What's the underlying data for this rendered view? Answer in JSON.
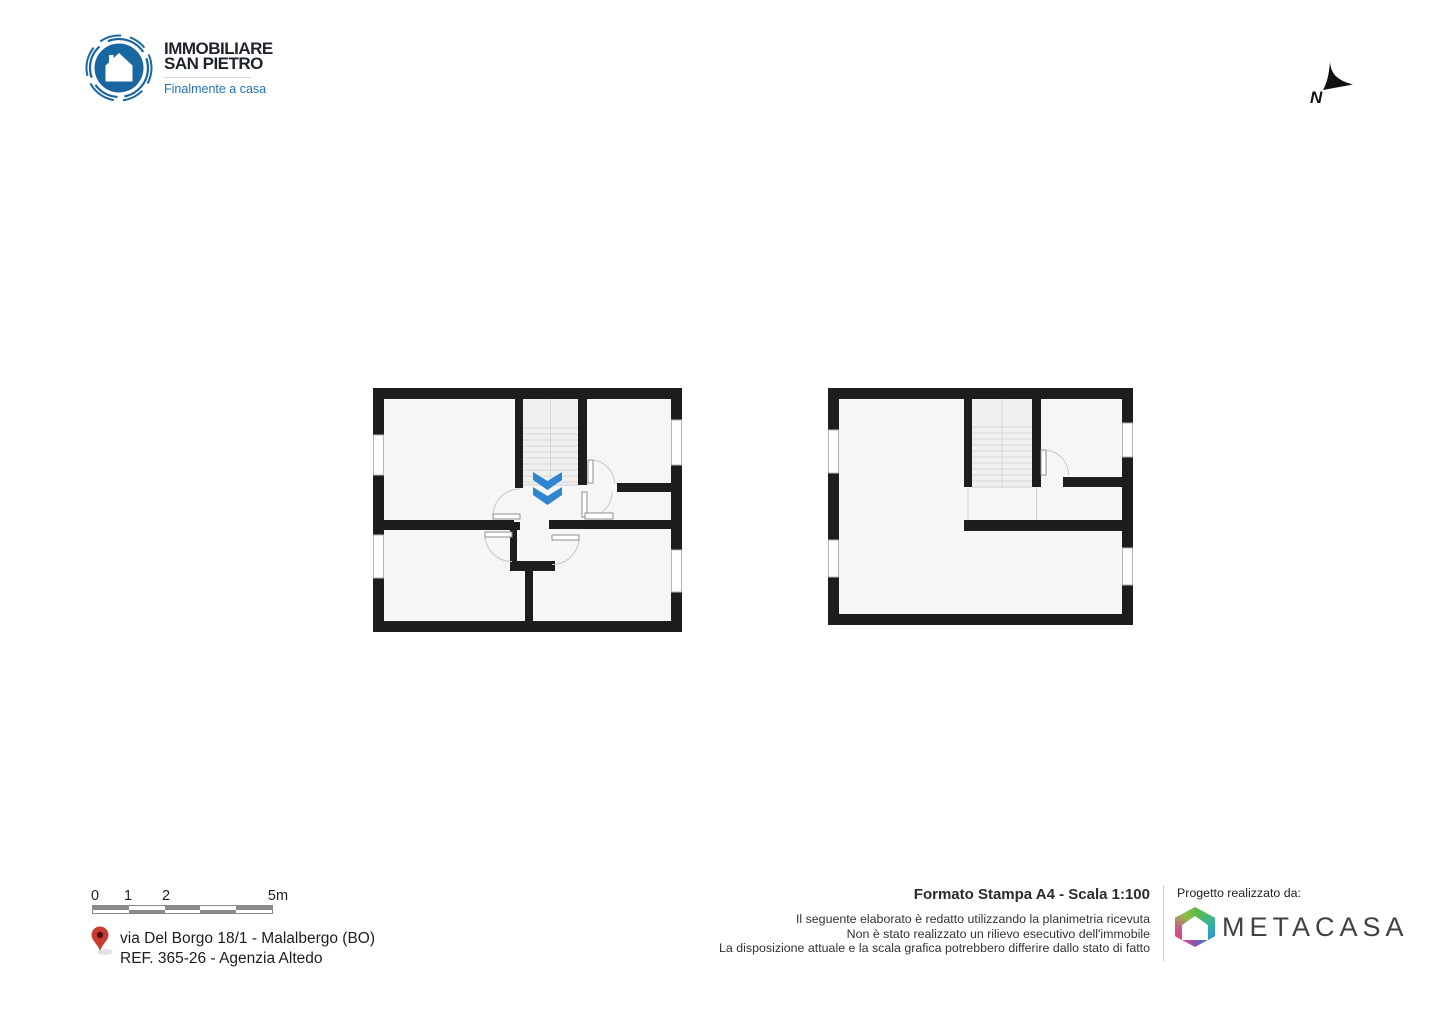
{
  "branding": {
    "name_line1": "IMMOBILIARE",
    "name_line2": "SAN PIETRO",
    "tagline": "Finalmente a casa",
    "logo_color": "#1a66a1",
    "tagline_color": "#2273b3"
  },
  "compass": {
    "label": "N"
  },
  "floor_plans": {
    "wall_color": "#1d1d1f",
    "room_fill": "#f6f6f7",
    "stair_fill": "#f0f0f1",
    "down_arrow_color": "#2e85d0",
    "plans": [
      {
        "id": "floor-plan-left",
        "features": "3 rooms, central staircase with down arrow, vestibule with two doors, 4 windows"
      },
      {
        "id": "floor-plan-right",
        "features": "open L-shaped room, staircase, one room with door, 4 windows"
      }
    ]
  },
  "scale_bar": {
    "labels": [
      "0",
      "1",
      "2",
      "5m"
    ],
    "gray": "#8a8a8a"
  },
  "address": {
    "line1": "via Del Borgo 18/1 - Malalbergo (BO)",
    "line2": "REF. 365-26 - Agenzia Altedo"
  },
  "print_info": {
    "title": "Formato Stampa A4 - Scala 1:100",
    "disclaimer_line1": "Il seguente elaborato è redatto utilizzando la planimetria ricevuta",
    "disclaimer_line2": "Non è stato realizzato un rilievo esecutivo dell'immobile",
    "disclaimer_line3": "La disposizione attuale e la scala grafica potrebbero differire dallo stato di fatto"
  },
  "credits": {
    "label": "Progetto realizzato da:",
    "brand": "METACASA"
  },
  "icons": {
    "agency_logo": "house-in-circle",
    "compass": "north-arrow",
    "address_pin": "map-pin",
    "credit_logo": "metacasa-gradient-house"
  }
}
